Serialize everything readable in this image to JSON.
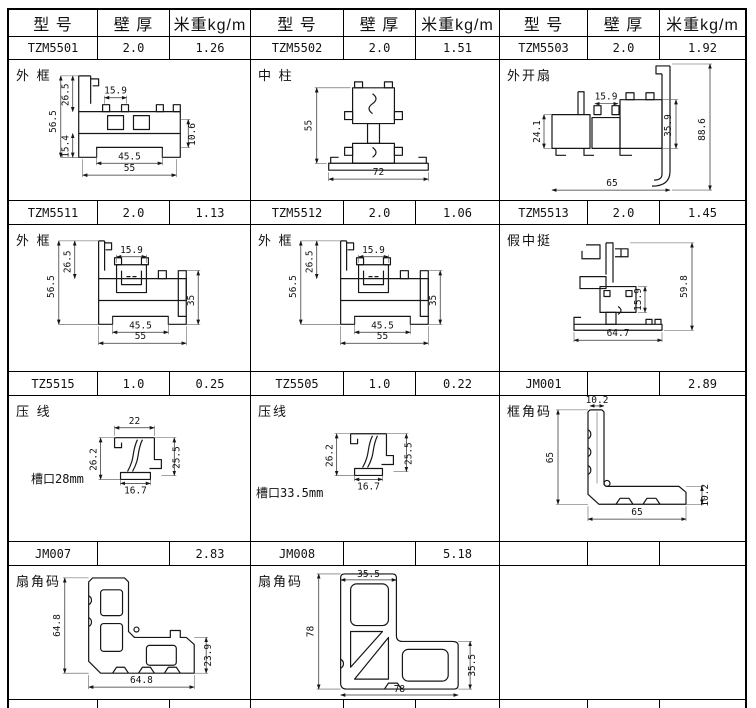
{
  "columns": {
    "model": "型 号",
    "thickness": "壁 厚",
    "weight": "米重kg/m"
  },
  "spec_rows": [
    [
      {
        "model": "TZM5501",
        "thickness": "2.0",
        "weight": "1.26"
      },
      {
        "model": "TZM5502",
        "thickness": "2.0",
        "weight": "1.51"
      },
      {
        "model": "TZM5503",
        "thickness": "2.0",
        "weight": "1.92"
      }
    ],
    [
      {
        "model": "TZM5511",
        "thickness": "2.0",
        "weight": "1.13"
      },
      {
        "model": "TZM5512",
        "thickness": "2.0",
        "weight": "1.06"
      },
      {
        "model": "TZM5513",
        "thickness": "2.0",
        "weight": "1.45"
      }
    ],
    [
      {
        "model": "TZ5515",
        "thickness": "1.0",
        "weight": "0.25"
      },
      {
        "model": "TZ5505",
        "thickness": "1.0",
        "weight": "0.22"
      },
      {
        "model": "JM001",
        "thickness": "",
        "weight": "2.89"
      }
    ],
    [
      {
        "model": "JM007",
        "thickness": "",
        "weight": "2.83"
      },
      {
        "model": "JM008",
        "thickness": "",
        "weight": "5.18"
      },
      {
        "model": "",
        "thickness": "",
        "weight": ""
      }
    ]
  ],
  "drawings": [
    [
      {
        "label": "外 框",
        "note": "",
        "dims": [
          "56.5",
          "26.5",
          "15.4",
          "15.9",
          "10.6",
          "45.5",
          "55"
        ]
      },
      {
        "label": "中 柱",
        "note": "",
        "dims": [
          "55",
          "72"
        ]
      },
      {
        "label": "外开扇",
        "note": "",
        "dims": [
          "24.1",
          "15.9",
          "35.9",
          "88.6",
          "65"
        ]
      }
    ],
    [
      {
        "label": "外 框",
        "note": "",
        "dims": [
          "56.5",
          "26.5",
          "15.9",
          "35",
          "45.5",
          "55"
        ]
      },
      {
        "label": "外 框",
        "note": "",
        "dims": [
          "56.5",
          "26.5",
          "15.9",
          "35",
          "45.5",
          "55"
        ]
      },
      {
        "label": "假中挺",
        "note": "",
        "dims": [
          "59.8",
          "15.9",
          "64.7"
        ]
      }
    ],
    [
      {
        "label": "压 线",
        "note": "槽口28mm",
        "dims": [
          "22",
          "26.2",
          "25.5",
          "16.7"
        ]
      },
      {
        "label": "压线",
        "note": "槽口33.5mm",
        "dims": [
          "26.2",
          "25.5",
          "16.7"
        ]
      },
      {
        "label": "框角码",
        "note": "",
        "dims": [
          "10.2",
          "65",
          "10.2",
          "65"
        ]
      }
    ],
    [
      {
        "label": "扇角码",
        "note": "",
        "dims": [
          "64.8",
          "23.9",
          "64.8"
        ]
      },
      {
        "label": "扇角码",
        "note": "",
        "dims": [
          "35.5",
          "78",
          "35.5",
          "78"
        ]
      },
      {
        "label": "",
        "note": "",
        "dims": []
      }
    ]
  ]
}
